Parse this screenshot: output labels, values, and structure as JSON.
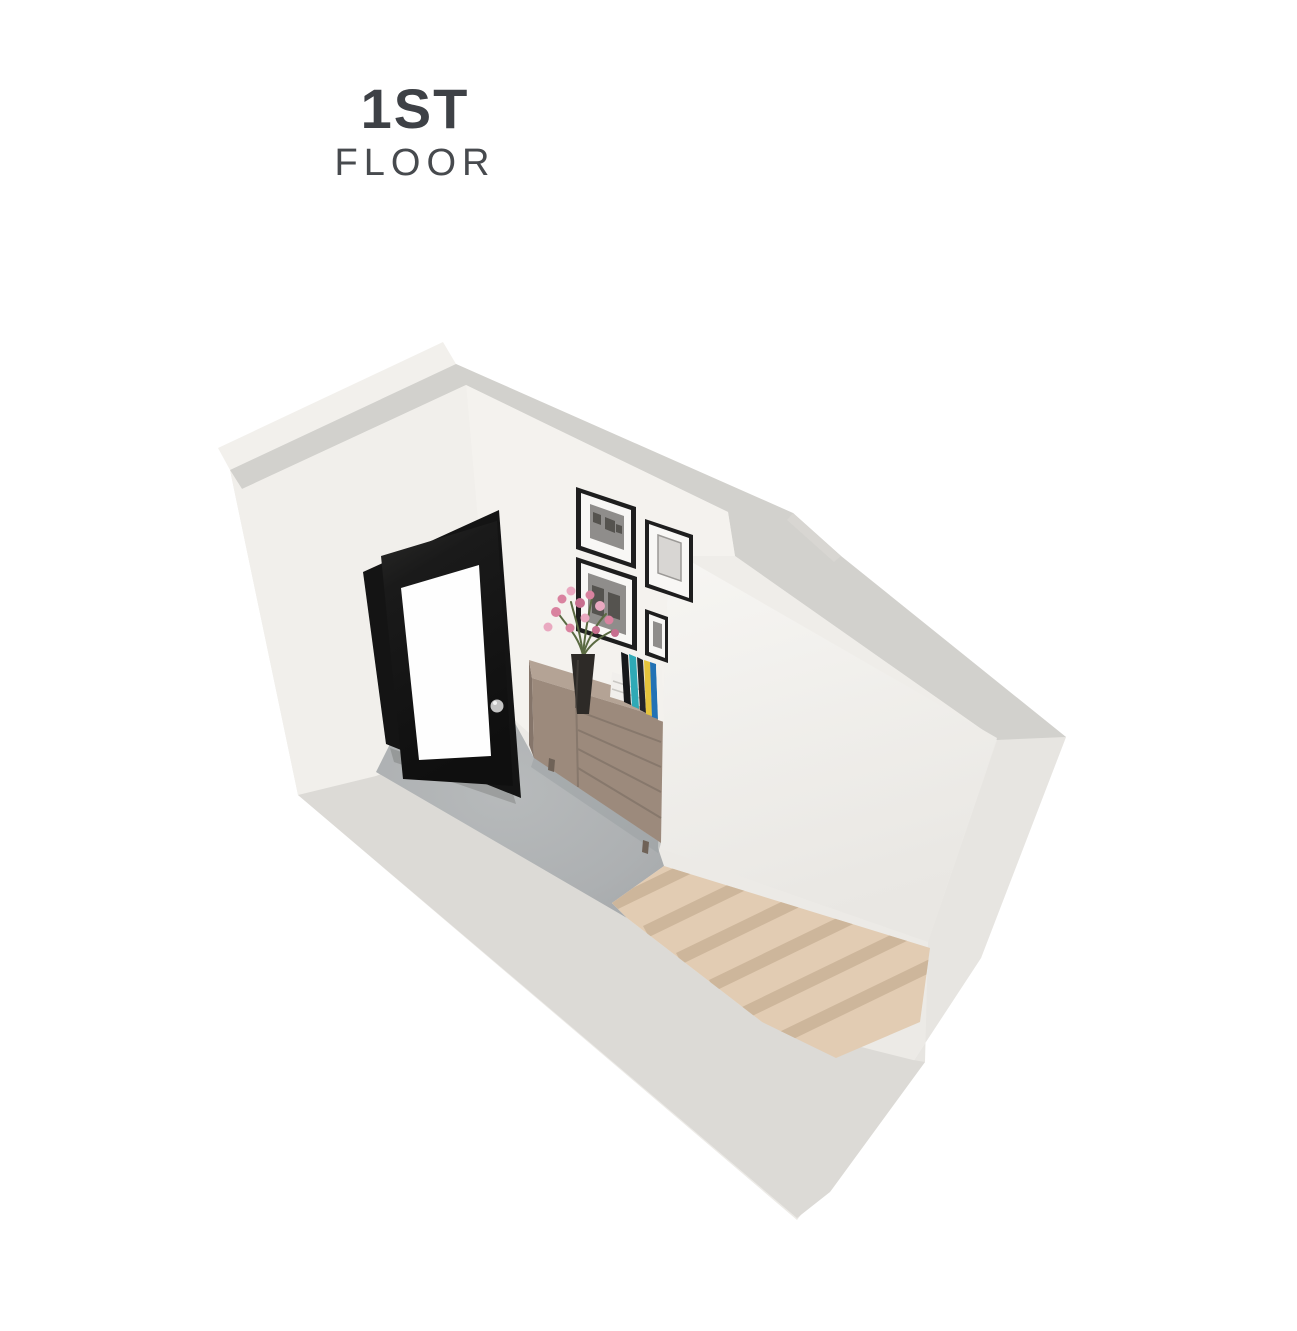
{
  "page": {
    "background": "#ffffff"
  },
  "header": {
    "floor_number": "1ST",
    "floor_label": "FLOOR"
  },
  "colors": {
    "title_primary": "#3E4146",
    "title_secondary": "#474A4E",
    "wall_top": "#D2D1CD",
    "wall_face_light": "#F2F0EC",
    "wall_face_base": "#ECEAE6",
    "wall_face_shaded": "#E7E5E1",
    "wall_bottom_band": "#DCDAD6",
    "interior_wall": "#F4F2EE",
    "middle_wall_top": "#F7F6F3",
    "middle_wall_bottom": "#E9E7E3",
    "carpet": "#AEB1B3",
    "stair_tread": "#E2CCB3",
    "stair_riser": "#CDB69B",
    "door_frame": "#141414",
    "door_leaf": "#1C1C1C",
    "door_glass": "#FEFEFE",
    "door_knob": "#C4C4C4",
    "dresser_front": "#9C8A7C",
    "dresser_top": "#B4A395",
    "dresser_side": "#85756A",
    "frame_black": "#1E1E1E",
    "frame_mat": "#F8F7F5",
    "photo_gray": "#8F8D8B",
    "flower_pink": "#D9829F",
    "flower_pink_light": "#E9A9C0",
    "stem_green": "#5A6A42",
    "vase_dark": "#2D2A27",
    "book_teal": "#2FA9B6",
    "book_yellow": "#E5C43C",
    "book_blue": "#2272B5",
    "book_black": "#17181A",
    "book_white": "#F3F1ED"
  },
  "scene": {
    "type": "3d-floorplan-render",
    "view": "isometric-top-down",
    "room": "entry-hallway-with-staircase",
    "elements": [
      "exterior-walls",
      "entry-door-open",
      "gallery-wall-frames",
      "sideboard",
      "books",
      "flower-vase",
      "carpet-floor",
      "wooden-staircase",
      "stair-landing"
    ],
    "frames_count": 4,
    "stair_steps": 6
  }
}
